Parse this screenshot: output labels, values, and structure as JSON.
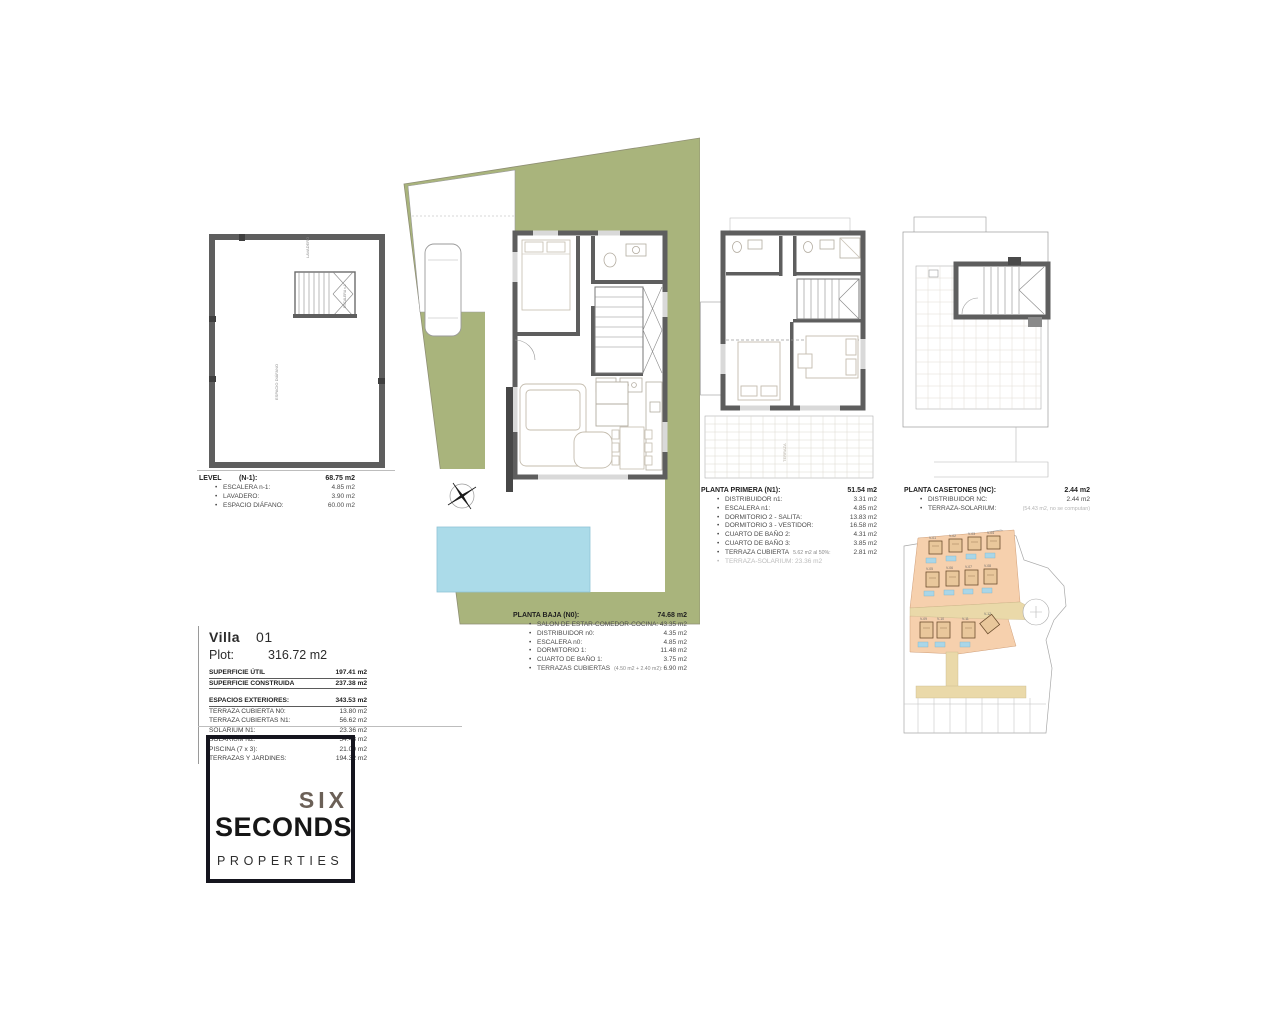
{
  "colors": {
    "site_green": "#a9b47c",
    "pool_blue": "#abdbe9",
    "wall_gray": "#5e5e5e",
    "plot_salmon": "#f6d0ad",
    "road_beige": "#ead9a9",
    "logo_dark": "#15151e",
    "six_brown": "#6b6057"
  },
  "level_n1": {
    "title": "LEVEL",
    "code": "(N-1):",
    "total": "68.75 m2",
    "items": [
      {
        "label": "ESCALERA n-1:",
        "value": "4.85 m2"
      },
      {
        "label": "LAVADERO:",
        "value": "3.90 m2"
      },
      {
        "label": "ESPACIO DIÁFANO:",
        "value": "60.00 m2"
      }
    ],
    "plan_labels": {
      "laundry": "LAVADERO",
      "stairs": "ESCALERA n-1",
      "room": "ESPACIO DIÁFANO"
    }
  },
  "planta_baja": {
    "title": "PLANTA BAJA (N0):",
    "total": "74.68 m2",
    "items": [
      {
        "label": "SALON DE ESTAR-COMEDOR-COCINA:",
        "value": "43.35 m2"
      },
      {
        "label": "DISTRIBUIDOR n0:",
        "value": "4.35 m2"
      },
      {
        "label": "ESCALERA n0:",
        "value": "4.85 m2"
      },
      {
        "label": "DORMITORIO 1:",
        "value": "11.48 m2"
      },
      {
        "label": "CUARTO DE BAÑO 1:",
        "value": "3.75 m2"
      },
      {
        "label": "TERRAZAS CUBIERTAS",
        "note": "(4.50 m2 + 2.40 m2):",
        "value": "6.90 m2"
      }
    ]
  },
  "planta_primera": {
    "title": "PLANTA PRIMERA (N1):",
    "total": "51.54 m2",
    "items": [
      {
        "label": "DISTRIBUIDOR n1:",
        "value": "3.31 m2"
      },
      {
        "label": "ESCALERA n1:",
        "value": "4.85 m2"
      },
      {
        "label": "DORMITORIO 2 - SALITA:",
        "value": "13.83 m2"
      },
      {
        "label": "DORMITORIO 3 - VESTIDOR:",
        "value": "16.58 m2"
      },
      {
        "label": "CUARTO DE BAÑO 2:",
        "value": "4.31 m2"
      },
      {
        "label": "CUARTO DE BAÑO 3:",
        "value": "3.85 m2"
      },
      {
        "label": "TERRAZA CUBIERTA",
        "note": "5.62 m2 al 50%:",
        "value": "2.81 m2"
      },
      {
        "label": "TERRAZA-SOLARIUM: 23.36 m2",
        "value": ""
      }
    ],
    "terrace_label": "TERRAZA"
  },
  "planta_casetones": {
    "title": "PLANTA CASETONES (NC):",
    "total": "2.44 m2",
    "items": [
      {
        "label": "DISTRIBUIDOR NC:",
        "value": "2.44 m2"
      },
      {
        "label": "TERRAZA-SOLARIUM:",
        "value": "(54.43 m2, no se computan)"
      }
    ]
  },
  "villa_info": {
    "name": "Villa",
    "number": "01",
    "plot_label": "Plot:",
    "plot_value": "316.72 m2",
    "util_label": "SUPERFICIE ÚTIL",
    "util_value": "197.41 m2",
    "const_label": "SUPERFICIE CONSTRUIDA",
    "const_value": "237.38 m2",
    "ext_label": "ESPACIOS EXTERIORES:",
    "ext_value": "343.53 m2",
    "rows": [
      {
        "label": "TERRAZA CUBIERTA N0:",
        "value": "13.80 m2"
      },
      {
        "label": "TERRAZA CUBIERTAS N1:",
        "value": "56.62 m2"
      },
      {
        "label": "SOLARIUM N1:",
        "value": "23.36 m2"
      },
      {
        "label": "SOLARIUM N2:",
        "value": "54.43 m2"
      },
      {
        "label": "PISCINA (7 x 3):",
        "value": "21.00 m2"
      },
      {
        "label": "TERRAZAS Y JARDINES:",
        "value": "194.32 m2"
      }
    ]
  },
  "logo": {
    "line1": "SIX",
    "line2": "SECONDS",
    "line3": "PROPERTIES"
  },
  "site_map": {
    "labels": [
      "V-01",
      "V-02",
      "V-03",
      "V-04",
      "V-05",
      "V-06",
      "V-07",
      "V-08",
      "V-09",
      "V-10",
      "V-11",
      "V-12"
    ]
  }
}
